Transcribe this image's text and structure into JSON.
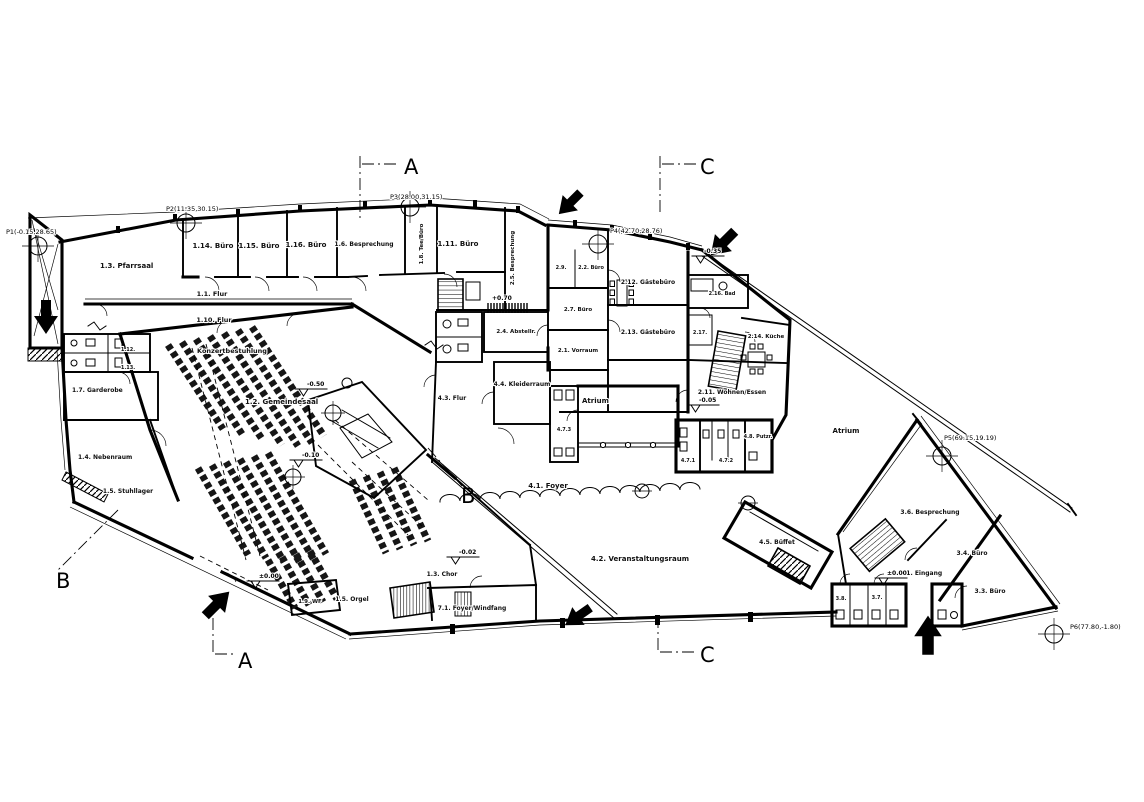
{
  "sections": {
    "a": "A",
    "b": "B",
    "c": "C"
  },
  "survey_points": {
    "p1": "P1(-0.15,28.65)",
    "p2": "P2(11.35,30.15)",
    "p3": "P3(28.00,31.15)",
    "p4": "P4(42.70,28.76)",
    "p5": "P5(69.15,19.19)",
    "p6": "P6(77.80,-1.80)"
  },
  "rooms": {
    "r1_1_flur": "1.1. Flur",
    "r1_10_flur": "1.10. Flur",
    "r1_2_saal": "1.2. Gemeindesaal",
    "r1_3_pfarrsaal": "1.3. Pfarrsaal",
    "r1_3_chor": "1.3. Chor",
    "r1_4": "1.4. Nebenraum",
    "r1_5_stuhl": "1.5. Stuhllager",
    "r1_5_orgel": "1.5. Orgel",
    "r1_6": "1.6. Besprechung",
    "r1_7": "1.7. Garderobe",
    "r1_8": "1.8. Tee/Büro",
    "r1_9": "1.9. WF",
    "r1_11": "1.11. Büro",
    "r1_12": "1.12.",
    "r1_13": "1.13.",
    "r1_14": "1.14. Büro",
    "r1_15": "1.15. Büro",
    "r1_16": "1.16. Büro",
    "r2_1": "2.1. Vorraum",
    "r2_2": "2.2. Büro",
    "r2_4": "2.4. Abstellr.",
    "r2_5": "2.5. Besprechung",
    "r2_7": "2.7. Büro",
    "r2_9": "2.9.",
    "r2_11": "2.11. Wohnen/Essen",
    "r2_12": "2.12. Gästebüro",
    "r2_13": "2.13. Gästebüro",
    "r2_14": "2.14. Küche",
    "r2_16": "2.16. Bad",
    "r2_17": "2.17.",
    "r3_1": "3.1. Eingang",
    "r3_3": "3.3. Büro",
    "r3_4": "3.4. Büro",
    "r3_6": "3.6. Besprechung",
    "r3_7": "3.7.",
    "r3_8": "3.8.",
    "r4_1": "4.1. Foyer",
    "r4_2": "4.2. Veranstaltungsraum",
    "r4_3": "4.3. Flur",
    "r4_4": "4.4. Kleiderraum",
    "r4_5": "4.5. Büffet",
    "r4_71": "4.7.1",
    "r4_72": "4.7.2",
    "r4_73": "4.7.3",
    "r4_8": "4.8. Putzr.",
    "r7_1": "7.1. Foyer/Windfang",
    "atrium": "Atrium",
    "atrium_right": "Atrium",
    "konzert": "Konzertbestuhlung"
  },
  "elevations": {
    "e1": "-0.50",
    "e2": "-0.10",
    "e3": "±0.00",
    "e4": "-0.02",
    "e5": "-0.05",
    "e6": "±0.00",
    "e7": "-0.35",
    "e8": "+0.70"
  },
  "icons": {
    "entrance_arrow": "filled-arrow",
    "survey_point": "crosshair-circle",
    "elevation_marker": "open-triangle-with-line"
  }
}
